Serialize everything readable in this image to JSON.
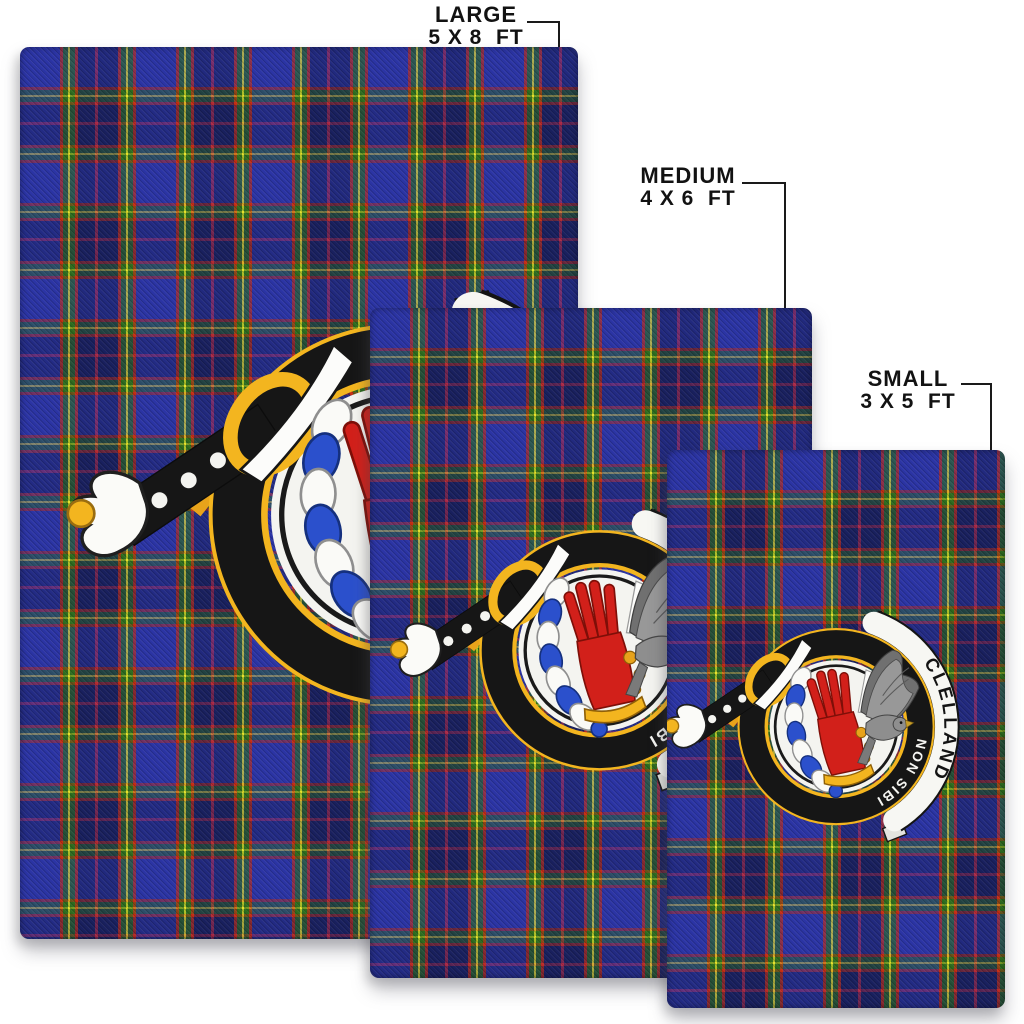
{
  "product": {
    "description": "Tartan area rugs shown in three sizes with clan crest badge",
    "variants": [
      {
        "label": "LARGE",
        "dimensions": "5 X 8  FT"
      },
      {
        "label": "MEDIUM",
        "dimensions": "4 X 6  FT"
      },
      {
        "label": "SMALL",
        "dimensions": "3 X 5  FT"
      }
    ],
    "crest": {
      "clan": "CLELLAND",
      "motto": "NON SIBI"
    }
  },
  "colors": {
    "background": "#ffffff",
    "label_text": "#121212",
    "leader_line": "#1a1a1a",
    "tartan_blue": "#2b34a4",
    "tartan_navy": "#19205e",
    "tartan_green": "#2d6c1f",
    "tartan_red": "#c62c12",
    "tartan_yellow": "#e7e32a",
    "badge_black": "#161616",
    "badge_gold": "#f3b51f",
    "scroll_white": "#f7f7f3",
    "glove_red": "#d2201a",
    "falcon_grey": "#8e8e8e",
    "torse_blue": "#2b50cc"
  }
}
